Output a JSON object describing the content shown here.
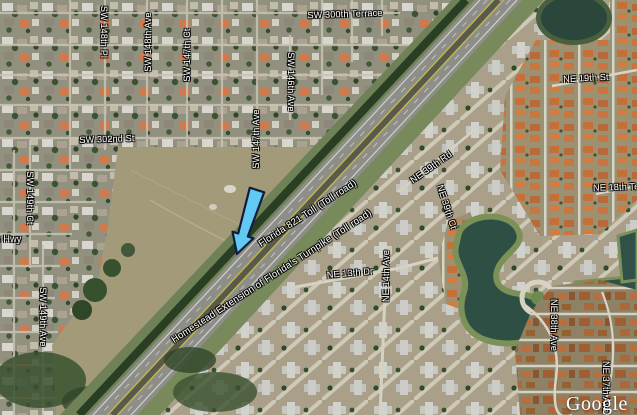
{
  "map": {
    "attribution": "Google",
    "streets": [
      {
        "text": "SW 300th Terrace"
      },
      {
        "text": "SW 148th Pl"
      },
      {
        "text": "SW 148th Ave"
      },
      {
        "text": "SW 147th Ct"
      },
      {
        "text": "SW 146th Ave"
      },
      {
        "text": "SW 147th Ave"
      },
      {
        "text": "SW 302nd St"
      },
      {
        "text": "SW 149th Ct"
      },
      {
        "text": "s Hwy"
      },
      {
        "text": "SW 149th Ave"
      },
      {
        "text": "NE 39th Rd"
      },
      {
        "text": "NE 39th Ct"
      },
      {
        "text": "NE 13th Dr"
      },
      {
        "text": "NE 14th Ave"
      },
      {
        "text": "NE 19th St"
      },
      {
        "text": "NE 18th Ter"
      },
      {
        "text": "NE 38th Ave"
      },
      {
        "text": "NE 37th Ave"
      }
    ],
    "highways": [
      {
        "text": "Florida 821 Toll (Toll road)"
      },
      {
        "text": "Homestead Extension of Florida's Turnpike (Toll road)"
      }
    ],
    "colors": {
      "arrow_fill": "#62c9f2",
      "arrow_outline": "#121d3c",
      "water": "#2e4f43",
      "field": "#a39a7a",
      "orange_roof": "#c66f39"
    }
  }
}
